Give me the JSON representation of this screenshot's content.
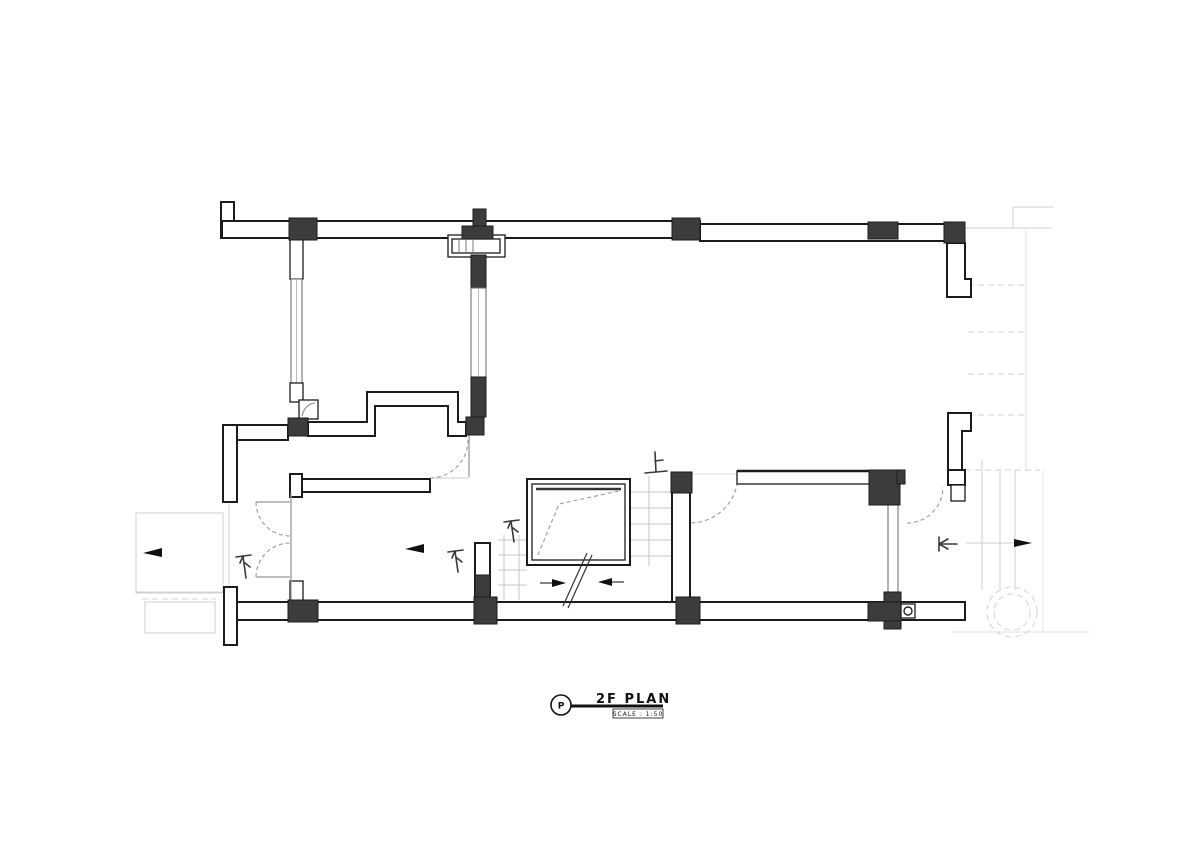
{
  "title_block": {
    "marker_letter": "P",
    "drawing_title": "2F PLAN",
    "scale_label": "SCALE :  1:50"
  },
  "annotations": {
    "down_marker_balcony": "下",
    "down_marker_room": "下",
    "down_marker_stair": "下",
    "up_marker_stair": "上"
  },
  "colors": {
    "wall_line": "#1b1b1b",
    "column_fill": "#3c3c3c",
    "thin_line": "#999999",
    "faint_line": "#cfcfcf",
    "dash_arc": "#9a9a9a",
    "background": "#ffffff"
  }
}
